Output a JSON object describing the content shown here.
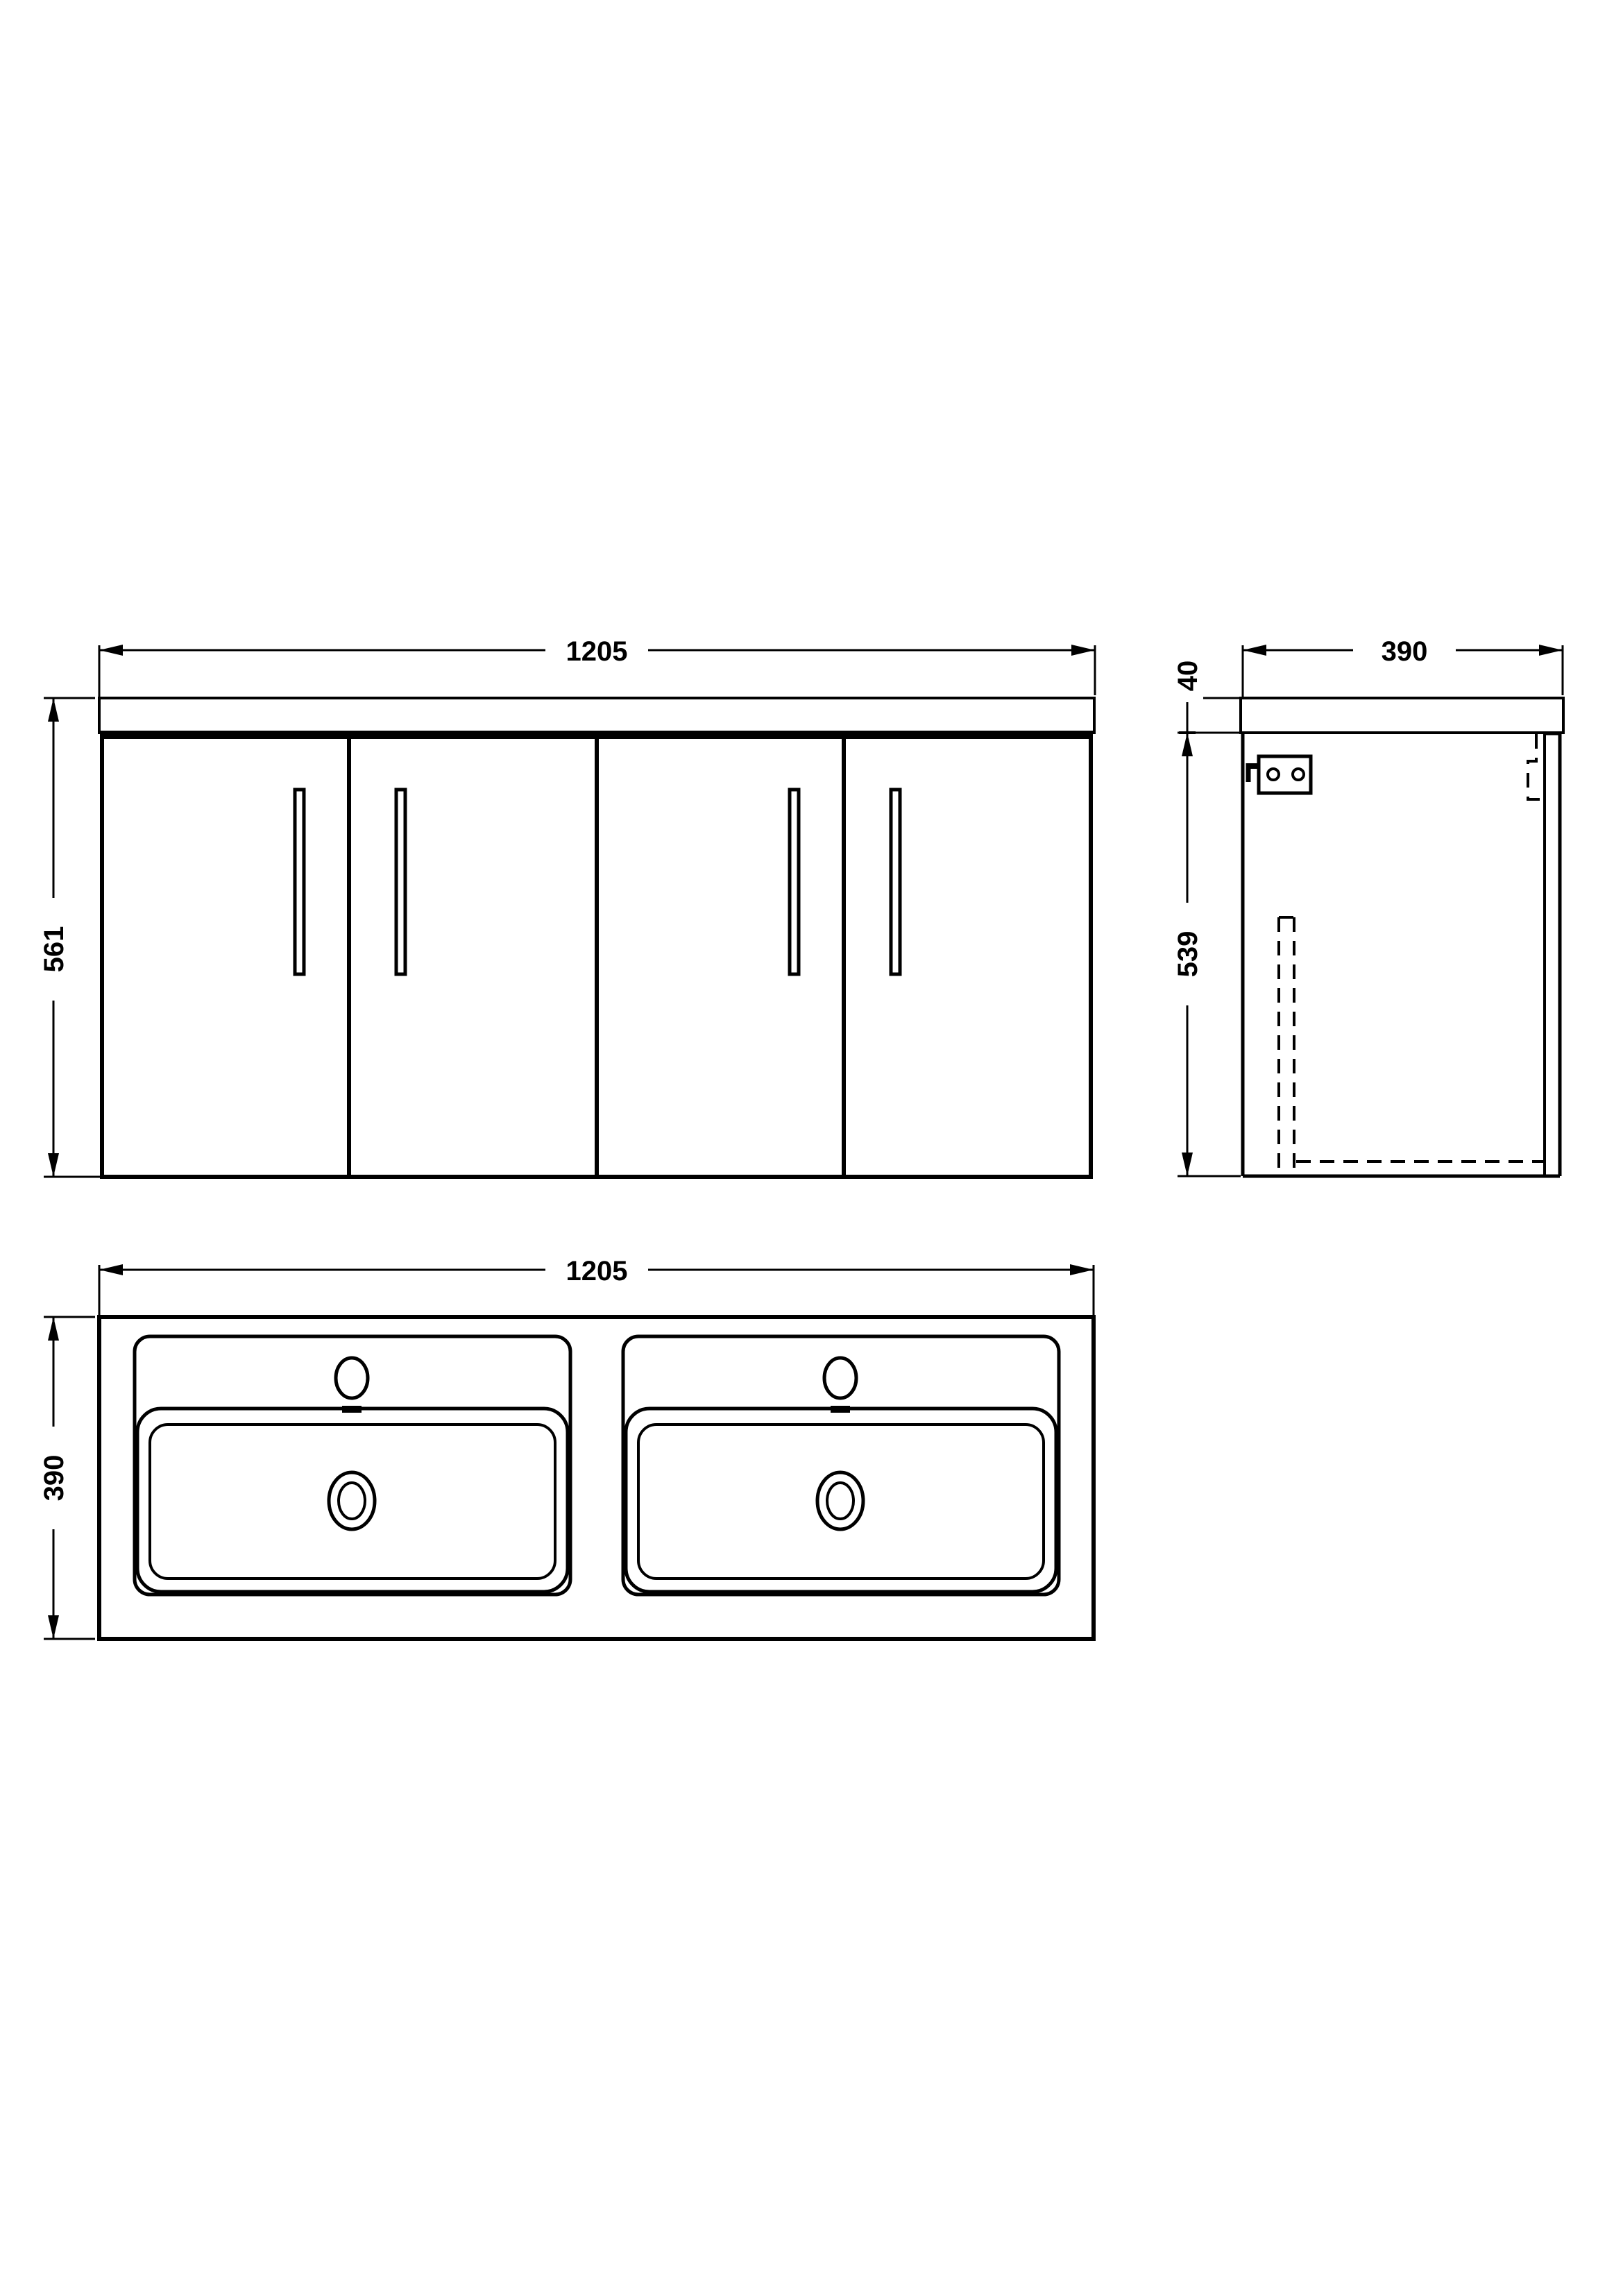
{
  "colors": {
    "background": "#ffffff",
    "line": "#000000",
    "text": "#000000"
  },
  "views": {
    "front": {
      "width_mm": "1205",
      "height_mm": "561"
    },
    "side": {
      "depth_mm": "390",
      "worktop_thickness_mm": "40",
      "carcass_height_mm": "539"
    },
    "plan": {
      "width_mm": "1205",
      "depth_mm": "390"
    }
  }
}
